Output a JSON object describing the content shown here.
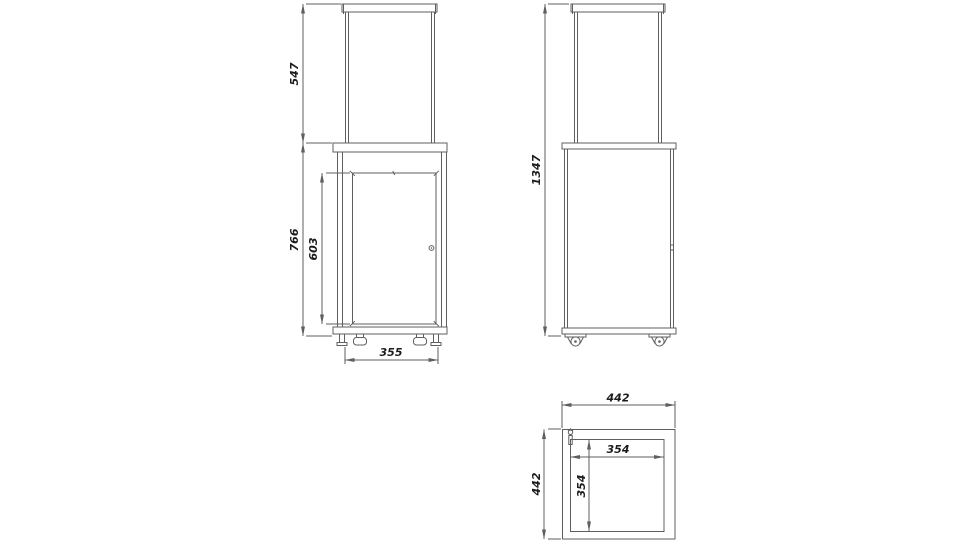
{
  "drawing": {
    "colors": {
      "background": "#ffffff",
      "line": "#5f5f5f",
      "dim_text": "#1c1c1c"
    },
    "views": {
      "front": {
        "name": "front-elevation",
        "dims": {
          "glass_section_height": "547",
          "body_height": "766",
          "door_height": "603",
          "feet_spacing": "355"
        }
      },
      "side": {
        "name": "side-elevation",
        "dims": {
          "overall_height": "1347"
        }
      },
      "top": {
        "name": "top-plan",
        "dims": {
          "outer_width": "442",
          "outer_depth": "442",
          "inner_width": "354",
          "inner_depth": "354"
        }
      }
    }
  }
}
